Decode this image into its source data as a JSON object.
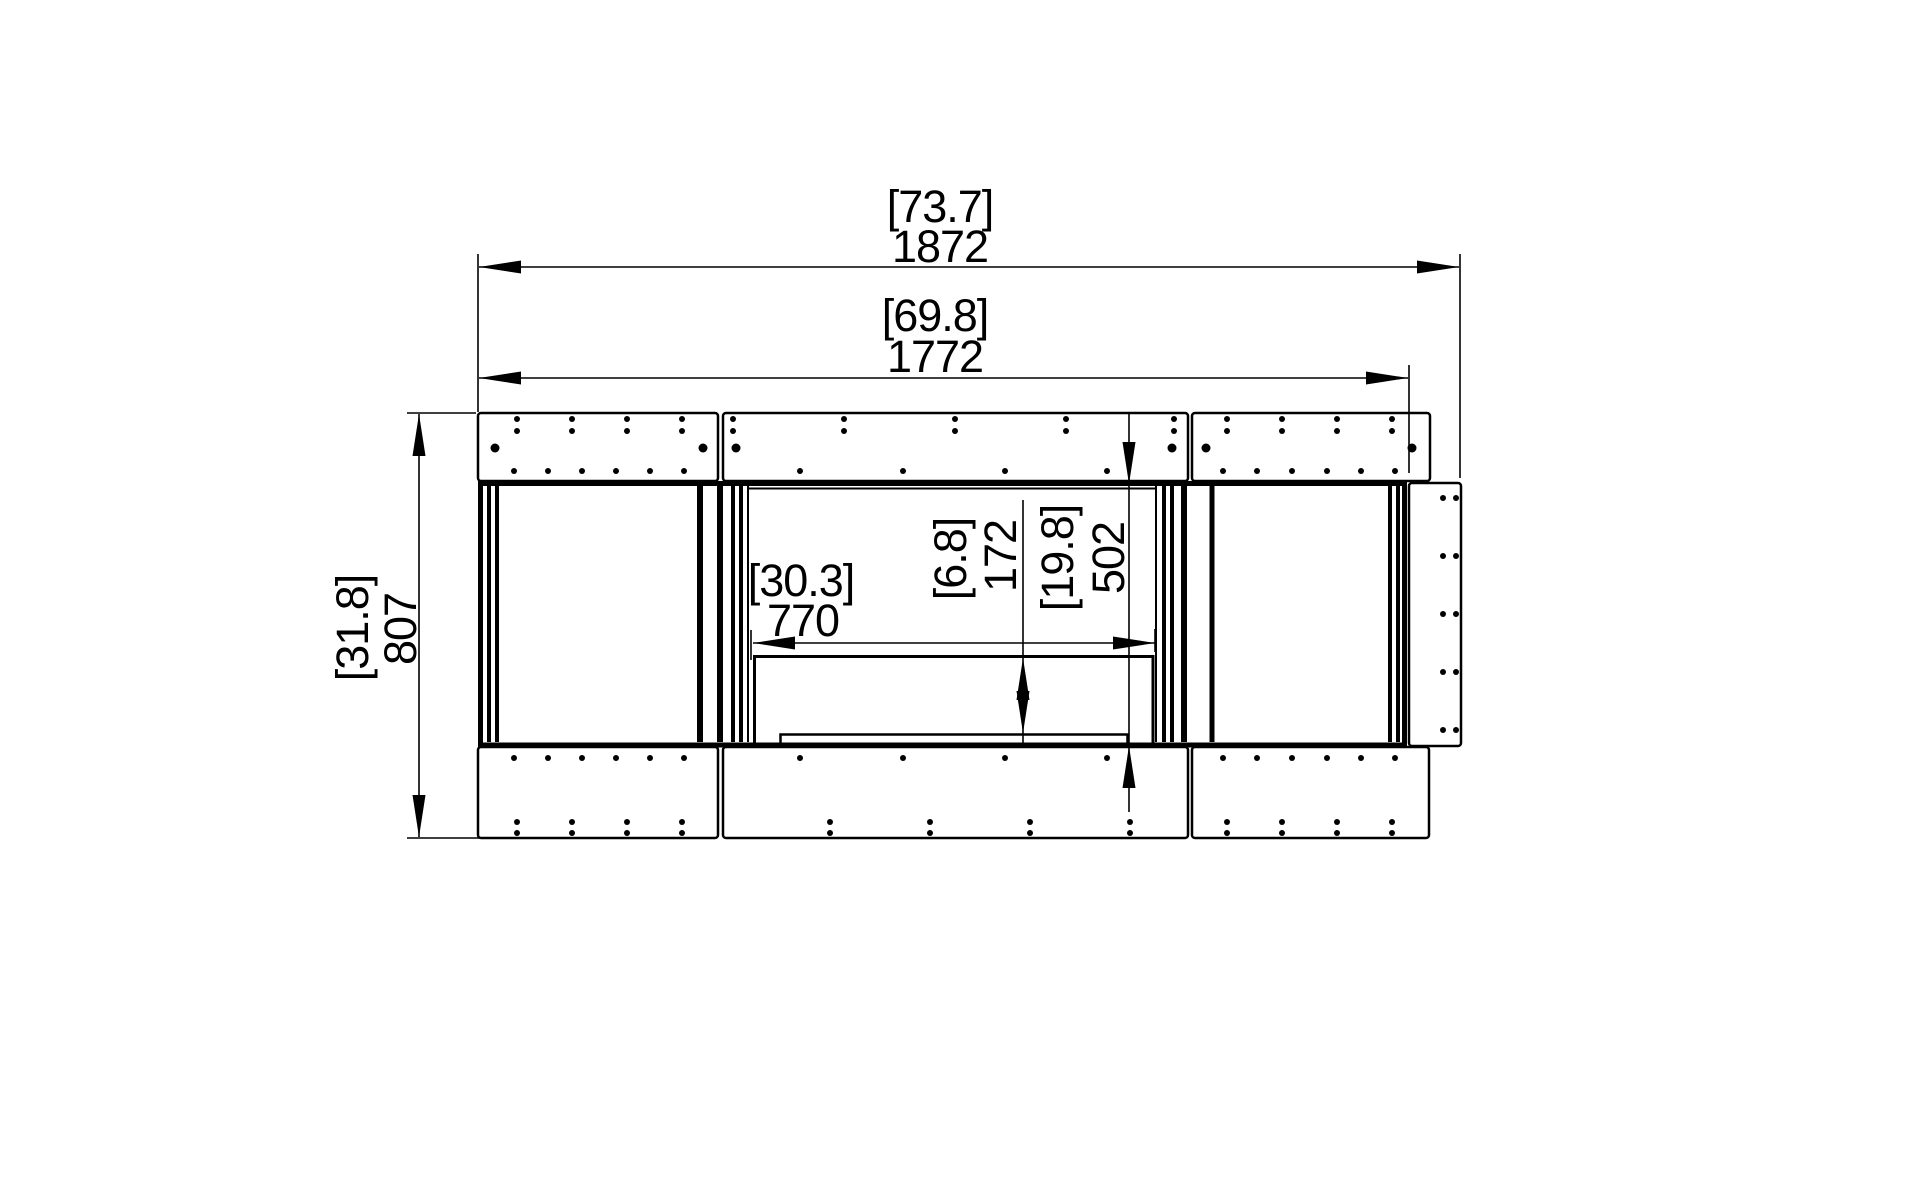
{
  "page": {
    "background": "#ffffff",
    "line_color": "#000000",
    "drawing_name": "firebox-front-elevation"
  },
  "dims": {
    "overall_width": {
      "bracket": "[73.7]",
      "value": "1872"
    },
    "body_width": {
      "bracket": "[69.8]",
      "value": "1772"
    },
    "overall_height": {
      "bracket": "[31.8]",
      "value": "807"
    },
    "opening_width": {
      "bracket": "[30.3]",
      "value": "770"
    },
    "burner_height": {
      "bracket": "[6.8]",
      "value": "172"
    },
    "opening_height": {
      "bracket": "[19.8]",
      "value": "502"
    }
  },
  "hardware": {
    "dot_rows": {
      "top_pairs_y": [
        419,
        431
      ],
      "top_big_y": 448,
      "top_singles_y": 471,
      "bottom_singles_y": 758,
      "bottom_pairs_y": [
        822,
        833
      ]
    },
    "top_panels": [
      {
        "x": 478,
        "y": 413,
        "w": 240,
        "h": 68,
        "pairs_x": [
          517,
          572,
          627,
          682
        ],
        "big_x": [
          495,
          703
        ],
        "singles_x": [
          514,
          548,
          582,
          616,
          650,
          684
        ]
      },
      {
        "x": 723,
        "y": 413,
        "w": 465,
        "h": 68,
        "pairs_x": [
          733,
          844,
          955,
          1066,
          1174
        ],
        "big_x": [
          736,
          1172
        ],
        "singles_x": [
          800,
          903,
          1005,
          1107
        ]
      },
      {
        "x": 1192,
        "y": 413,
        "w": 238,
        "h": 68,
        "pairs_x": [
          1227,
          1282,
          1337,
          1392
        ],
        "big_x": [
          1206,
          1412
        ],
        "singles_x": [
          1223,
          1257,
          1292,
          1327,
          1361,
          1395
        ]
      }
    ],
    "bottom_panels": [
      {
        "x": 478,
        "y": 747,
        "w": 240,
        "h": 91,
        "singles_x": [
          514,
          548,
          582,
          616,
          650,
          684
        ],
        "pairs_x": [
          517,
          572,
          627,
          682
        ]
      },
      {
        "x": 723,
        "y": 747,
        "w": 465,
        "h": 91,
        "singles_x": [
          800,
          903,
          1005,
          1107
        ],
        "pairs_x": [
          830,
          930,
          1030,
          1130
        ]
      },
      {
        "x": 1192,
        "y": 747,
        "w": 237,
        "h": 91,
        "singles_x": [
          1223,
          1257,
          1292,
          1327,
          1361,
          1395
        ],
        "pairs_x": [
          1227,
          1282,
          1337,
          1392
        ]
      }
    ],
    "right_flange": {
      "x": 1409,
      "y": 483,
      "w": 52,
      "h": 263,
      "cols_x": [
        1443,
        1456
      ],
      "rows_y": [
        498,
        556,
        614,
        672,
        730
      ]
    }
  }
}
